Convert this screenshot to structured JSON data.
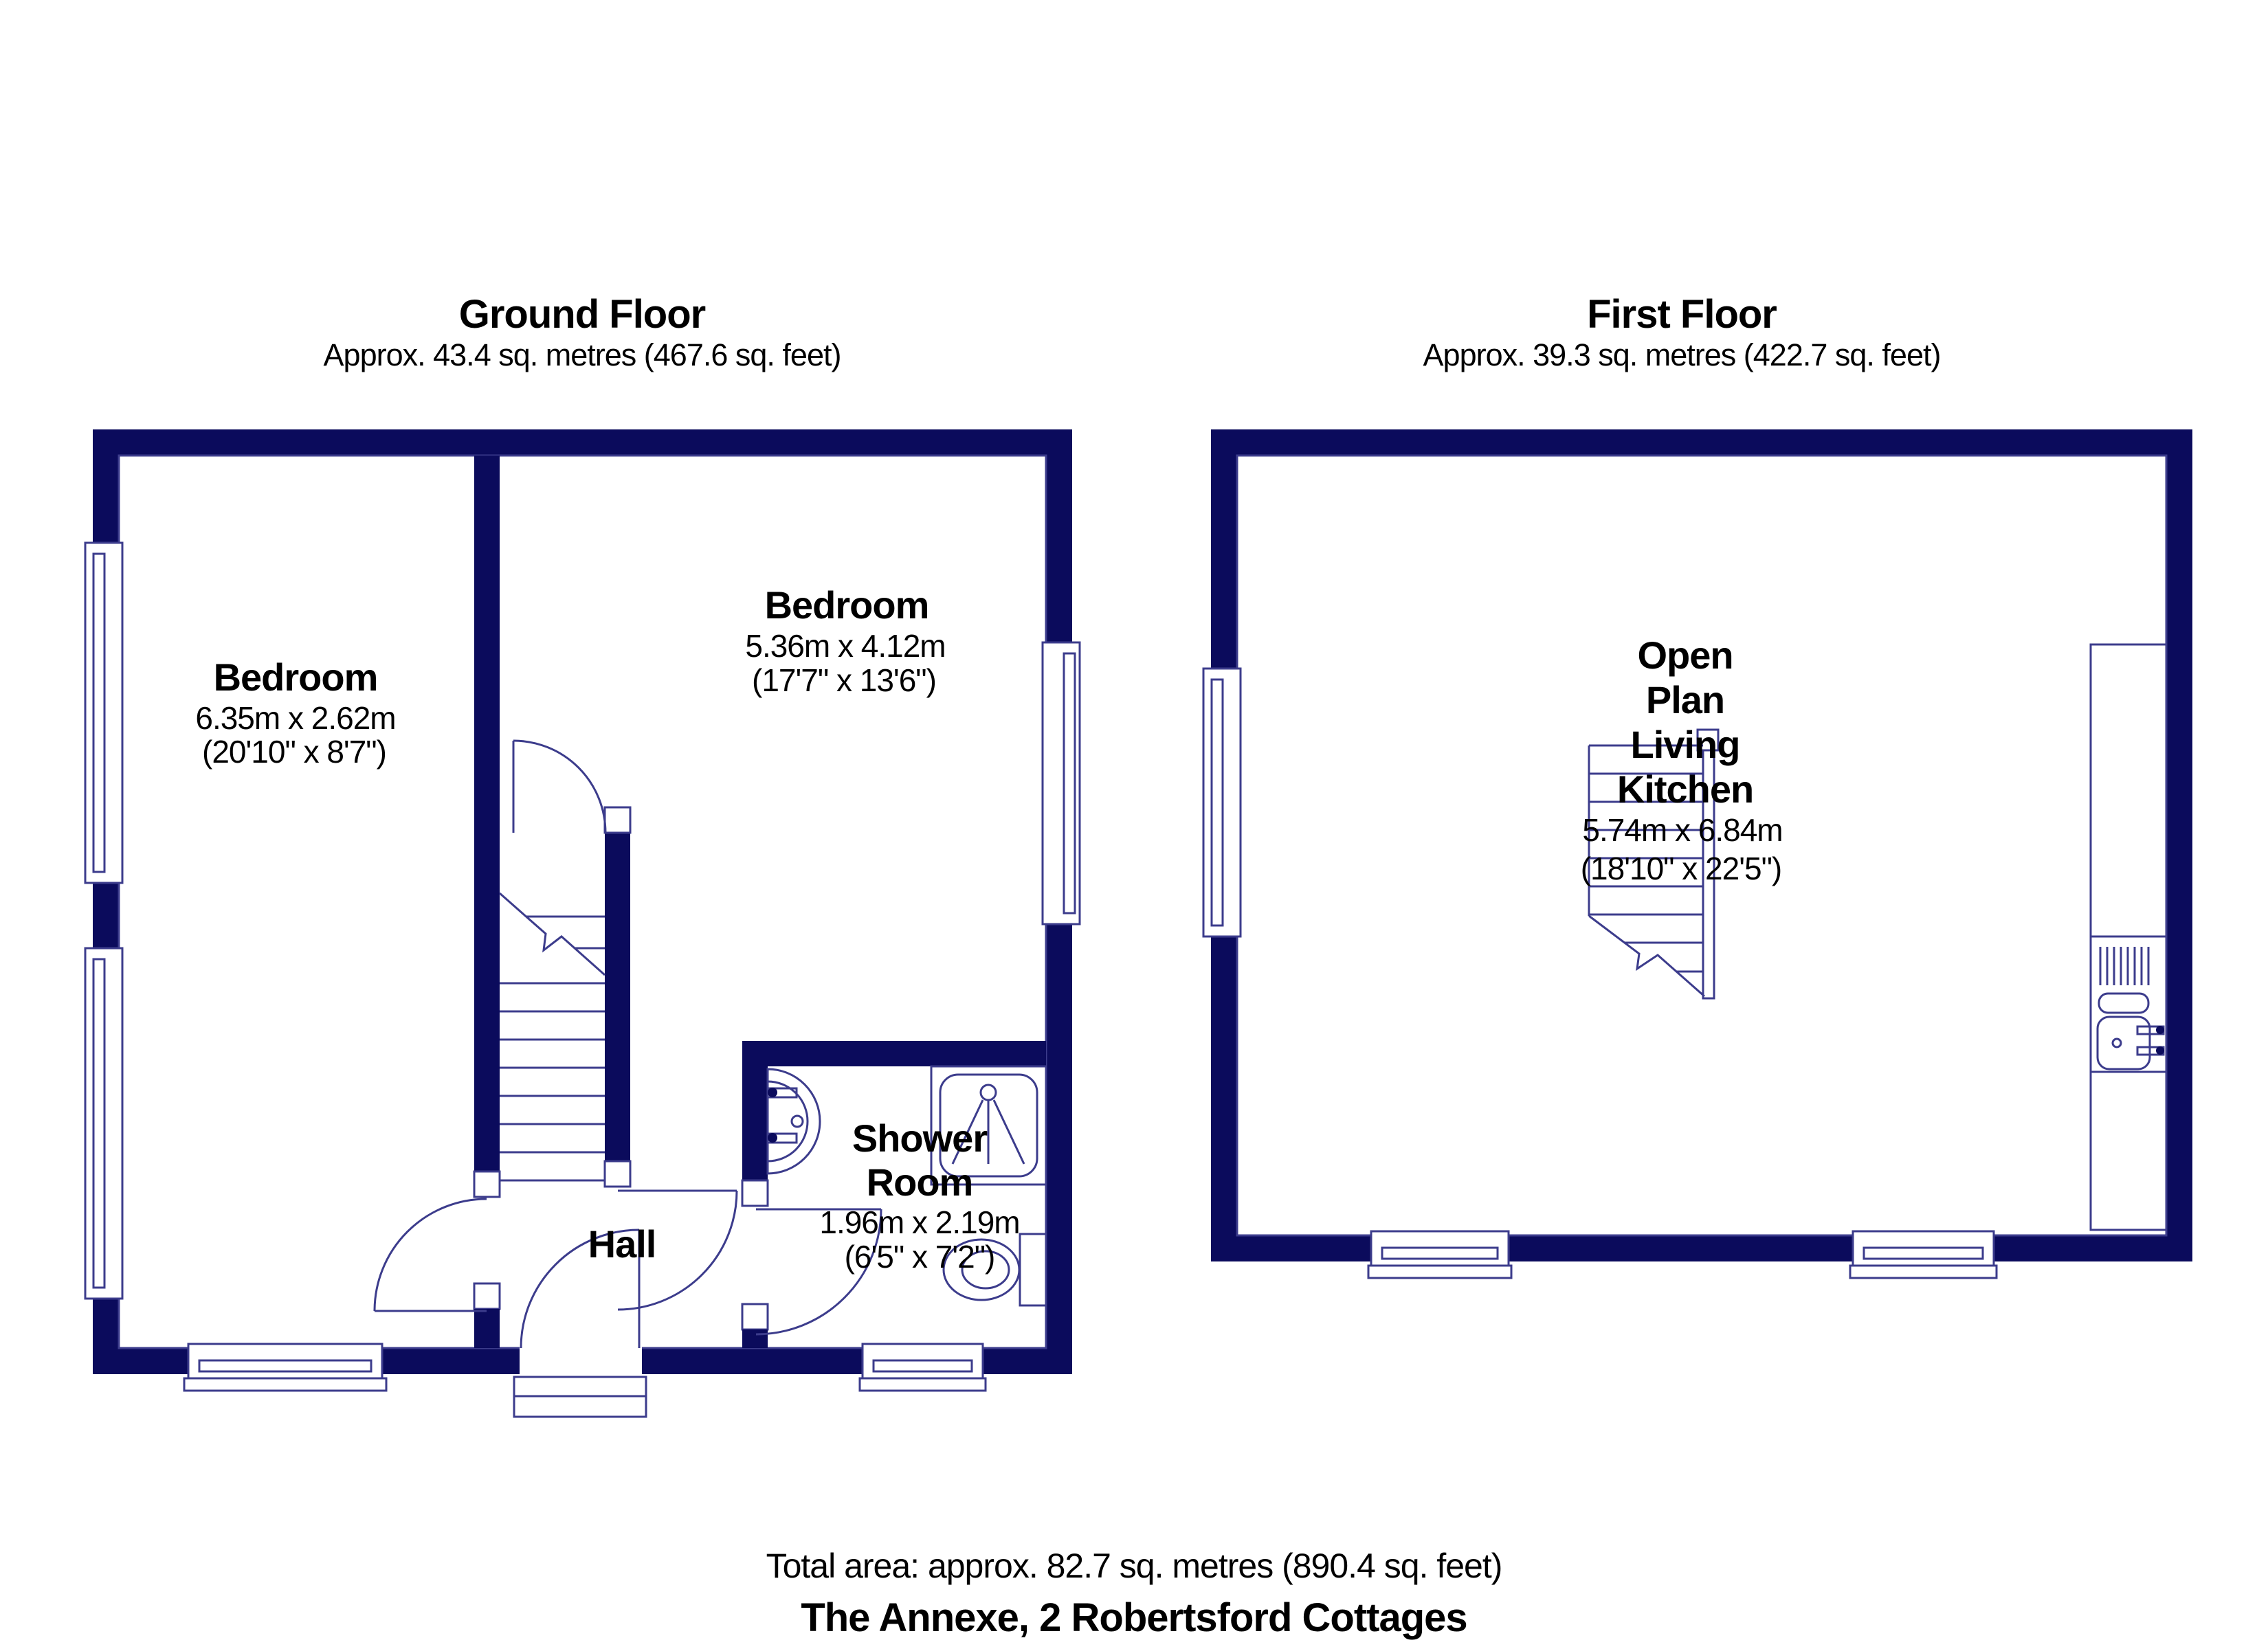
{
  "colors": {
    "wall": "#0b0b5c",
    "line": "#3c3c8c",
    "text": "#000000"
  },
  "ground_floor": {
    "title": "Ground Floor",
    "area": "Approx. 43.4 sq. metres (467.6 sq. feet)",
    "rooms": {
      "bedroom_left": {
        "name": "Bedroom",
        "dims_m": "6.35m x 2.62m",
        "dims_ft": "(20'10\" x 8'7\")"
      },
      "bedroom_right": {
        "name": "Bedroom",
        "dims_m": "5.36m x 4.12m",
        "dims_ft": "(17'7\" x 13'6\")"
      },
      "shower_room": {
        "name_lines": [
          "Shower",
          "Room"
        ],
        "dims_m": "1.96m x 2.19m",
        "dims_ft": "(6'5\" x 7'2\")"
      },
      "hall": {
        "name": "Hall"
      }
    }
  },
  "first_floor": {
    "title": "First Floor",
    "area": "Approx. 39.3 sq. metres (422.7 sq. feet)",
    "rooms": {
      "open_plan_living_kitchen": {
        "name_lines": [
          "Open",
          "Plan",
          "Living",
          "Kitchen"
        ],
        "dims_m": "5.74m x 6.84m",
        "dims_ft": "(18'10\" x 22'5\")"
      }
    }
  },
  "footer": {
    "total_area": "Total area: approx. 82.7 sq. metres (890.4 sq. feet)",
    "property_name": "The Annexe, 2 Robertsford Cottages"
  }
}
